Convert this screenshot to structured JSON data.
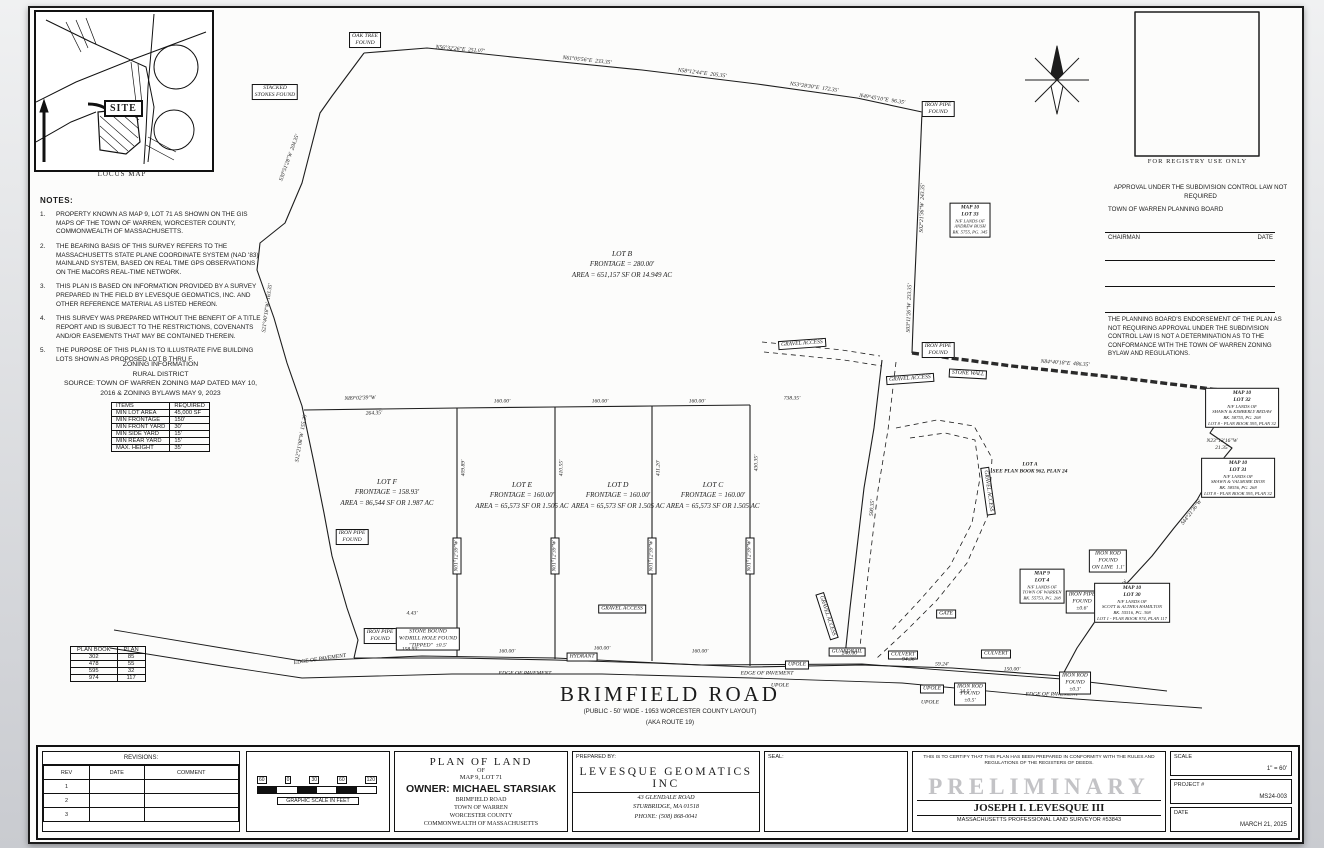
{
  "locus": {
    "site_label": "SITE",
    "caption": "LOCUS MAP"
  },
  "notes": {
    "title": "NOTES:",
    "items": [
      "PROPERTY KNOWN AS MAP 9, LOT 71 AS SHOWN ON THE GIS MAPS OF THE TOWN OF WARREN, WORCESTER COUNTY, COMMONWEALTH OF MASSACHUSETTS.",
      "THE BEARING BASIS OF THIS SURVEY REFERS TO THE MASSACHUSETTS STATE PLANE COORDINATE SYSTEM (NAD '83) MAINLAND SYSTEM, BASED ON REAL TIME GPS OBSERVATIONS ON THE MaCORS REAL-TIME NETWORK.",
      "THIS PLAN IS BASED ON INFORMATION PROVIDED BY A SURVEY PREPARED IN THE FIELD BY LEVESQUE GEOMATICS, INC. AND OTHER REFERENCE MATERIAL AS LISTED HEREON.",
      "THIS SURVEY WAS PREPARED WITHOUT THE BENEFIT OF A TITLE REPORT AND IS SUBJECT TO THE RESTRICTIONS, COVENANTS AND/OR EASEMENTS THAT MAY BE CONTAINED THEREIN.",
      "THE PURPOSE OF THIS PLAN IS TO ILLUSTRATE FIVE BUILDING LOTS SHOWN AS PROPOSED LOT B THRU F."
    ]
  },
  "zoning": {
    "title1": "ZONING INFORMATION",
    "title2": "RURAL DISTRICT",
    "source1": "SOURCE: TOWN OF WARREN ZONING MAP DATED MAY 10,",
    "source2": "2016 & ZONING BYLAWS MAY 9, 2023",
    "headers": [
      "ITEMS",
      "REQUIRED"
    ],
    "rows": [
      [
        "MIN LOT AREA",
        "45,000 SF"
      ],
      [
        "MIN FRONTAGE",
        "150'"
      ],
      [
        "MIN FRONT YARD",
        "30'"
      ],
      [
        "MIN SIDE YARD",
        "15'"
      ],
      [
        "MIN REAR YARD",
        "15'"
      ],
      [
        "MAX. HEIGHT",
        "35'"
      ]
    ]
  },
  "plan_book": {
    "headers": [
      "PLAN BOOK",
      "PLAN"
    ],
    "rows": [
      [
        "302",
        "85"
      ],
      [
        "478",
        "55"
      ],
      [
        "595",
        "32"
      ],
      [
        "974",
        "117"
      ]
    ]
  },
  "registry": {
    "caption": "FOR REGISTRY USE ONLY",
    "approval": "APPROVAL UNDER THE SUBDIVISION CONTROL LAW NOT REQUIRED",
    "board": "TOWN OF WARREN PLANNING BOARD",
    "chairman": "CHAIRMAN",
    "date": "DATE",
    "endorsement": "THE PLANNING BOARD'S ENDORSEMENT OF THE PLAN AS NOT REQUIRING APPROVAL UNDER THE SUBDIVISION CONTROL LAW IS NOT A DETERMINATION AS TO THE CONFORMANCE WITH THE TOWN OF WARREN ZONING BYLAW AND REGULATIONS."
  },
  "road": {
    "name": "BRIMFIELD ROAD",
    "sub1": "(PUBLIC - 50' WIDE - 1953 WORCESTER COUNTY LAYOUT)",
    "sub2": "(AKA ROUTE 19)"
  },
  "titleblock": {
    "revisions": {
      "title": "REVISIONS:",
      "headers": [
        "REV",
        "DATE",
        "COMMENT"
      ],
      "rows": [
        "1",
        "2",
        "3"
      ]
    },
    "scalebar": {
      "caption": "GRAPHIC SCALE IN FEET",
      "ticks": [
        "60",
        "0",
        "30",
        "60",
        "120"
      ]
    },
    "plan": {
      "l1": "PLAN OF LAND",
      "l2": "OF",
      "l3": "MAP 9, LOT 71",
      "owner": "OWNER: MICHAEL STARSIAK",
      "l5": "BRIMFIELD ROAD",
      "l6": "TOWN OF WARREN",
      "l7": "WORCESTER COUNTY",
      "l8": "COMMONWEALTH OF MASSACHUSETTS"
    },
    "prepared": {
      "label": "PREPARED BY:",
      "company": "LEVESQUE GEOMATICS INC",
      "addr1": "43 GLENDALE ROAD",
      "addr2": "STURBRIDGE, MA 01518",
      "phone": "PHONE: (508) 868-0041"
    },
    "seal": {
      "label": "SEAL:"
    },
    "cert": {
      "text": "THIS IS TO CERTIFY THAT THIS PLAN HAS BEEN PREPARED IN CONFORMITY WITH THE RULES AND REGULATIONS OF THE REGISTERS OF DEEDS.",
      "stamp": "PRELIMINARY",
      "name": "JOSEPH I. LEVESQUE III",
      "title": "MASSACHUSETTS PROFESSIONAL LAND SURVEYOR #53843"
    },
    "meta": {
      "scale_label": "SCALE",
      "scale_value": "1\" = 60'",
      "project_label": "PROJECT #",
      "project_value": "MS24-003",
      "date_label": "DATE",
      "date_value": "MARCH 21, 2025"
    }
  },
  "survey": {
    "lots": [
      {
        "name": "LOT B",
        "l1": "FRONTAGE = 280.00'",
        "l2": "AREA = 651,157 SF OR 14.949 AC",
        "x": 592,
        "y": 256
      },
      {
        "name": "LOT F",
        "l1": "FRONTAGE = 158.93'",
        "l2": "AREA = 86,544 SF OR 1.987 AC",
        "x": 357,
        "y": 484
      },
      {
        "name": "LOT E",
        "l1": "FRONTAGE = 160.00'",
        "l2": "AREA = 65,573 SF OR 1.505 AC",
        "x": 492,
        "y": 487
      },
      {
        "name": "LOT D",
        "l1": "FRONTAGE = 160.00'",
        "l2": "AREA = 65,573 SF OR 1.505 AC",
        "x": 588,
        "y": 487
      },
      {
        "name": "LOT C",
        "l1": "FRONTAGE = 160.00'",
        "l2": "AREA = 65,573 SF OR 1.505 AC",
        "x": 683,
        "y": 487
      }
    ],
    "parcels": [
      {
        "x": 940,
        "y": 212,
        "lines": [
          "MAP 10",
          "LOT 33",
          "N/F LANDS OF",
          "ANDREW BUSH",
          "BK. 5755, PG. 345"
        ]
      },
      {
        "x": 1212,
        "y": 400,
        "lines": [
          "MAP 10",
          "LOT 32",
          "N/F LANDS OF",
          "SHAWN & KIMBERLY BEDAW",
          "BK. 58755, PG. 208",
          "LOT 8 - PLAN BOOK 595, PLAN 32"
        ]
      },
      {
        "x": 1208,
        "y": 470,
        "lines": [
          "MAP 10",
          "LOT 31",
          "N/F LANDS OF",
          "SHAWN & VALMORE DION",
          "BK. 58556, PG. 268",
          "LOT 8 - PLAN BOOK 595, PLAN 32"
        ]
      },
      {
        "x": 1012,
        "y": 578,
        "lines": [
          "MAP 9",
          "LOT 4",
          "N/F LANDS OF",
          "TOWN OF WARREN",
          "BK. 55753, PG. 208"
        ]
      },
      {
        "x": 1102,
        "y": 595,
        "lines": [
          "MAP 10",
          "LOT 30",
          "N/F LANDS OF",
          "SCOTT & ALTHEA HAMILTON",
          "BK. 55516, PG. 308",
          "LOT 1 - PLAN BOOK 974, PLAN 117"
        ]
      },
      {
        "x": 1000,
        "y": 460,
        "nb": true,
        "lines": [
          "LOT A",
          "SEE PLAN BOOK 962, PLAN 24"
        ]
      }
    ],
    "labels": [
      {
        "t": "STACKED\nSTONES FOUND",
        "x": 245,
        "y": 84,
        "b": true
      },
      {
        "t": "OAK TREE\nFOUND",
        "x": 335,
        "y": 32,
        "b": true
      },
      {
        "t": "IRON PIPE\nFOUND",
        "x": 908,
        "y": 101,
        "b": true
      },
      {
        "t": "IRON PIPE\nFOUND",
        "x": 908,
        "y": 342,
        "b": true
      },
      {
        "t": "GRAVEL ACCESS",
        "x": 772,
        "y": 336,
        "b": true,
        "r": -4
      },
      {
        "t": "GRAVEL ACCESS",
        "x": 880,
        "y": 371,
        "b": true,
        "r": -4
      },
      {
        "t": "STONE WALL",
        "x": 938,
        "y": 366,
        "b": true,
        "r": 3
      },
      {
        "t": "GRAVEL ACCESS",
        "x": 958,
        "y": 483,
        "b": true,
        "r": 82
      },
      {
        "t": "GRAVEL ACCESS",
        "x": 797,
        "y": 608,
        "b": true,
        "r": 72
      },
      {
        "t": "GRAVEL ACCESS",
        "x": 592,
        "y": 601,
        "b": true
      },
      {
        "t": "IRON PIPE\nFOUND",
        "x": 322,
        "y": 529,
        "b": true
      },
      {
        "t": "IRON PIPE\nFOUND",
        "x": 350,
        "y": 628,
        "b": true
      },
      {
        "t": "STONE BOUND\nW/DRILL HOLE FOUND\n\"TIPPED\"  ±0.5'",
        "x": 398,
        "y": 631,
        "b": true
      },
      {
        "t": "HYDRANT",
        "x": 552,
        "y": 649,
        "b": true
      },
      {
        "t": "EDGE OF PAVEMENT",
        "x": 290,
        "y": 652,
        "b": false,
        "r": -8
      },
      {
        "t": "EDGE OF PAVEMENT",
        "x": 495,
        "y": 666,
        "b": false
      },
      {
        "t": "EDGE OF PAVEMENT",
        "x": 737,
        "y": 666,
        "b": false
      },
      {
        "t": "EDGE OF PAVEMENT",
        "x": 1022,
        "y": 687,
        "b": false
      },
      {
        "t": "UPOLE",
        "x": 767,
        "y": 657,
        "b": true
      },
      {
        "t": "GUARDRAIL",
        "x": 817,
        "y": 644,
        "b": true
      },
      {
        "t": "CULVERT",
        "x": 873,
        "y": 647,
        "b": true
      },
      {
        "t": "UPOLE",
        "x": 902,
        "y": 681,
        "b": true
      },
      {
        "t": "IRON ROD\nFOUND\n±0.5'",
        "x": 940,
        "y": 686,
        "b": true
      },
      {
        "t": "GATE",
        "x": 916,
        "y": 606,
        "b": true
      },
      {
        "t": "CULVERT",
        "x": 966,
        "y": 646,
        "b": true
      },
      {
        "t": "IRON ROD\nFOUND\nON LINE  1.1'",
        "x": 1078,
        "y": 553,
        "b": true
      },
      {
        "t": "IRON PIPE\nFOUND\n±0.6'",
        "x": 1052,
        "y": 594,
        "b": true
      },
      {
        "t": "IRON ROD\nFOUND\n±0.3'",
        "x": 1045,
        "y": 675,
        "b": true
      },
      {
        "t": "N56°32'26\"E  251.07'",
        "x": 430,
        "y": 42,
        "r": 5
      },
      {
        "t": "N61°05'56\"E  233.35'",
        "x": 557,
        "y": 53,
        "r": 6
      },
      {
        "t": "N58°12'44\"E  205.35'",
        "x": 672,
        "y": 66,
        "r": 7
      },
      {
        "t": "N53°28'30\"E  172.35'",
        "x": 784,
        "y": 80,
        "r": 8
      },
      {
        "t": "N49°45'10\"E  96.35'",
        "x": 852,
        "y": 92,
        "r": 9
      },
      {
        "t": "S30°51'28\"W  204.35'",
        "x": 260,
        "y": 150,
        "r": -70
      },
      {
        "t": "S21°40'18\"W  163.35'",
        "x": 238,
        "y": 300,
        "r": -82
      },
      {
        "t": "S12°21'08\"W  155.20'",
        "x": 272,
        "y": 430,
        "r": -80
      },
      {
        "t": "S02°21'36\"W  243.35'",
        "x": 893,
        "y": 200,
        "r": -88
      },
      {
        "t": "S03°11'26\"W  233.35'",
        "x": 880,
        "y": 300,
        "r": -88
      },
      {
        "t": "N84°40'18\"E  486.35'",
        "x": 1035,
        "y": 356,
        "r": 4
      },
      {
        "t": "N23°13'16\"W\n21.35'",
        "x": 1192,
        "y": 437
      },
      {
        "t": "S44°21'36\"W",
        "x": 1162,
        "y": 505,
        "r": -52
      },
      {
        "t": "S38°11'22\"W",
        "x": 1088,
        "y": 585,
        "r": -52
      },
      {
        "t": "N89°02'39\"W",
        "x": 330,
        "y": 391,
        "r": -2
      },
      {
        "t": "264.35'",
        "x": 344,
        "y": 406,
        "r": -2
      },
      {
        "t": "160.00'",
        "x": 472,
        "y": 394
      },
      {
        "t": "160.00'",
        "x": 570,
        "y": 394
      },
      {
        "t": "160.00'",
        "x": 667,
        "y": 394
      },
      {
        "t": "738.35'",
        "x": 762,
        "y": 391
      },
      {
        "t": "N01°12'39\"W",
        "x": 427,
        "y": 548,
        "r": -90,
        "b": true
      },
      {
        "t": "N01°12'39\"W",
        "x": 525,
        "y": 548,
        "r": -90,
        "b": true
      },
      {
        "t": "N01°12'39\"W",
        "x": 622,
        "y": 548,
        "r": -90,
        "b": true
      },
      {
        "t": "N01°12'39\"W",
        "x": 720,
        "y": 548,
        "r": -90,
        "b": true
      },
      {
        "t": "409.89'",
        "x": 434,
        "y": 460,
        "r": -90
      },
      {
        "t": "410.55'",
        "x": 532,
        "y": 460,
        "r": -90
      },
      {
        "t": "411.20'",
        "x": 629,
        "y": 460,
        "r": -90
      },
      {
        "t": "430.35'",
        "x": 727,
        "y": 455,
        "r": -90
      },
      {
        "t": "500.35'",
        "x": 843,
        "y": 500,
        "r": -85
      },
      {
        "t": "4.43'",
        "x": 382,
        "y": 606
      },
      {
        "t": "158.93'",
        "x": 380,
        "y": 642
      },
      {
        "t": "160.00'",
        "x": 477,
        "y": 644
      },
      {
        "t": "160.00'",
        "x": 572,
        "y": 641
      },
      {
        "t": "160.00'",
        "x": 670,
        "y": 644
      },
      {
        "t": "240.00'",
        "x": 820,
        "y": 646
      },
      {
        "t": "94.36'",
        "x": 879,
        "y": 652
      },
      {
        "t": "59.24'",
        "x": 912,
        "y": 657
      },
      {
        "t": "24.5'",
        "x": 935,
        "y": 684
      },
      {
        "t": "150.00'",
        "x": 982,
        "y": 662
      },
      {
        "t": "UPOLE",
        "x": 750,
        "y": 678
      },
      {
        "t": "UPOLE",
        "x": 900,
        "y": 695
      }
    ]
  }
}
